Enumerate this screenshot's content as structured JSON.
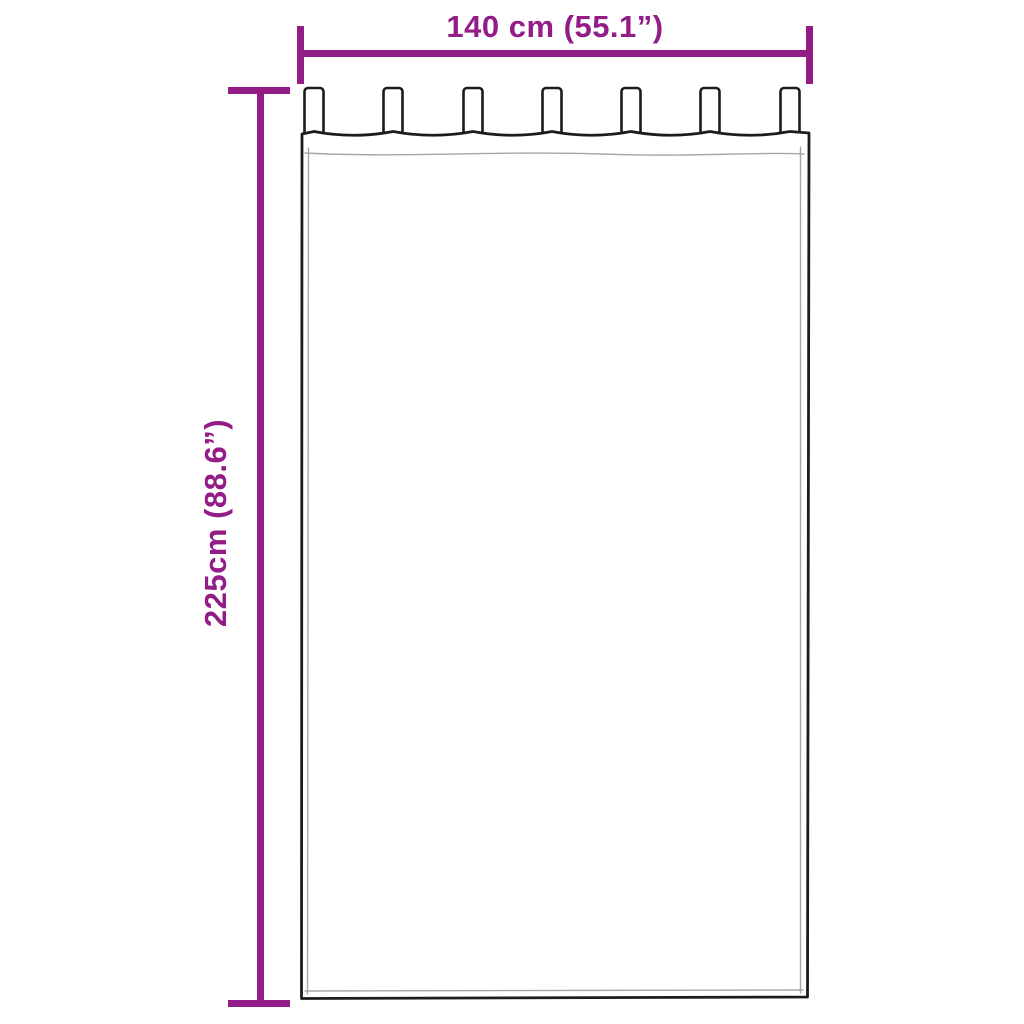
{
  "colors": {
    "background": "#ffffff",
    "dimension_accent": "#931c87",
    "outline": "#1c1c1c",
    "hem_line": "#a6a6a6"
  },
  "dimensions": {
    "width": {
      "label": "140 cm (55.1”)"
    },
    "height": {
      "label": "225cm (88.6”)"
    }
  },
  "drawing": {
    "tab_count": 7
  }
}
